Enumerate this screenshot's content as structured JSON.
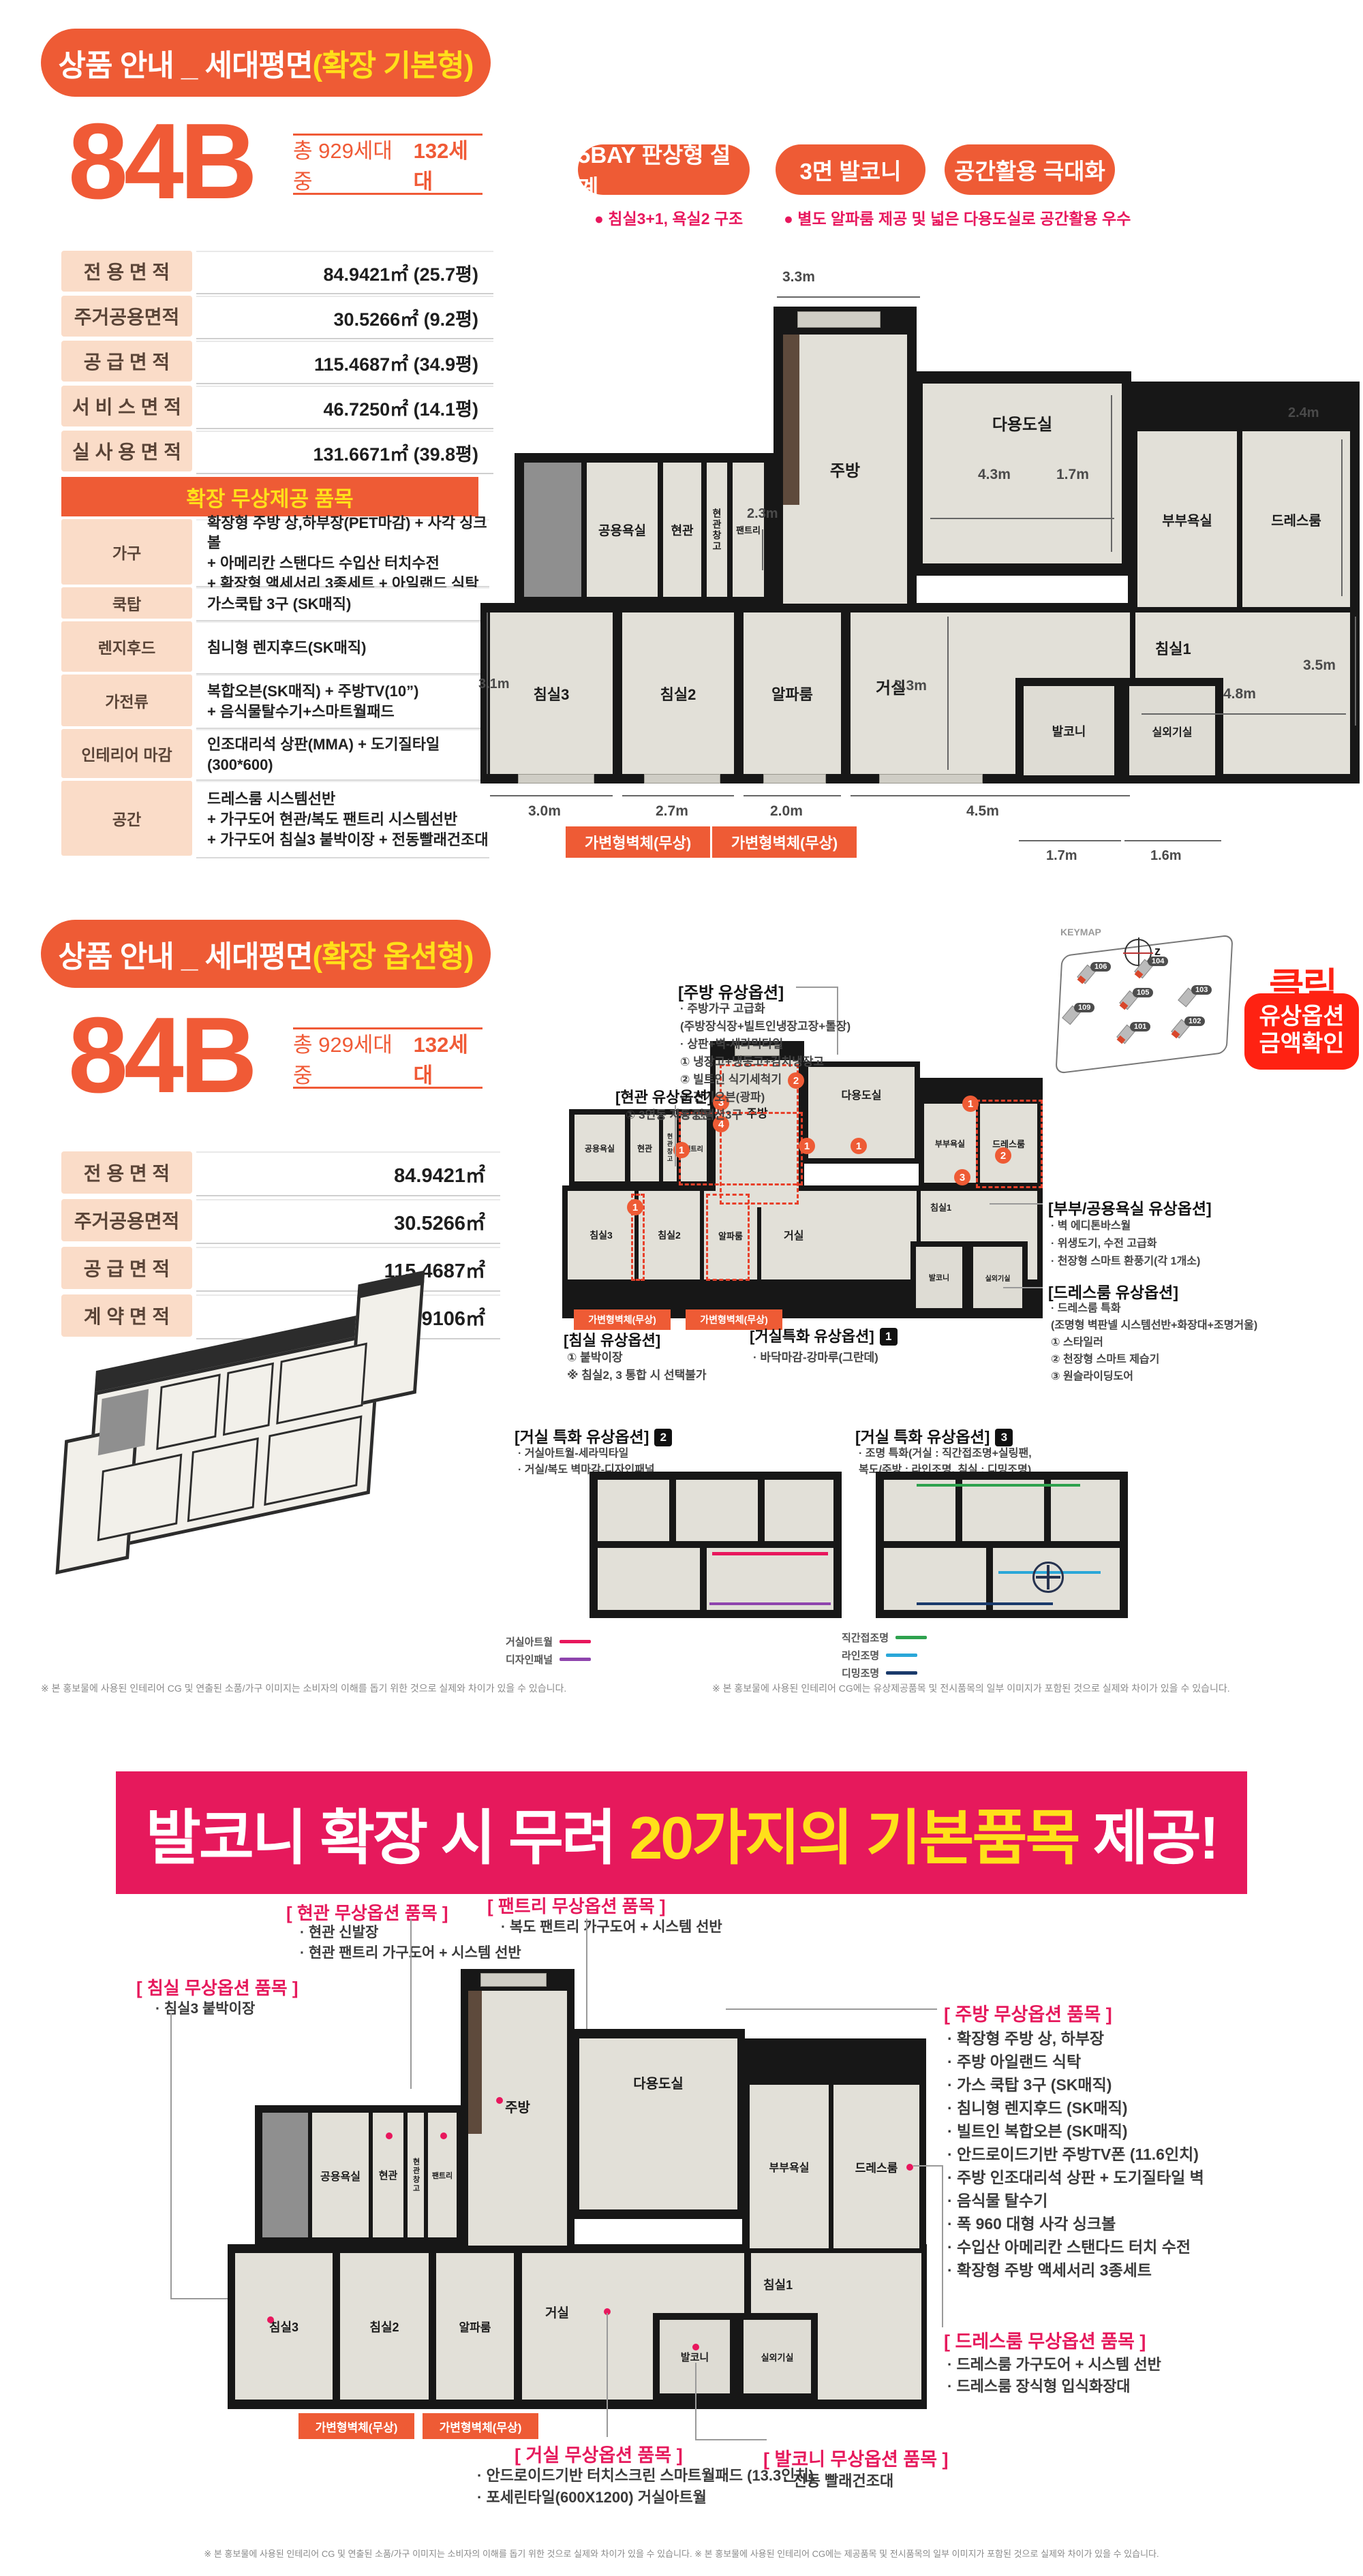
{
  "rooms": {
    "kitchen": "주방",
    "utility": "다용도실",
    "bath_common": "공용욕실",
    "entry": "현관",
    "entry_closet": "현관창고",
    "pantry": "팬트리",
    "bath_master": "부부욕실",
    "dress": "드레스룸",
    "bed3": "침실3",
    "bed2": "침실2",
    "alpha": "알파룸",
    "living": "거실",
    "bed1": "침실1",
    "balcony": "발코니",
    "ac_room": "실외기실"
  },
  "wall_tag": "가변형벽체(무상)",
  "section1": {
    "header_title": "상품 안내 _ 세대평면",
    "header_sub": "(확장 기본형)",
    "unit_code": "84B",
    "households_prefix": "총 929세대 중 ",
    "households_bold": "132세대",
    "badges": [
      "5BAY 판상형 설계",
      "3면 발코니",
      "공간활용 극대화"
    ],
    "badge_notes": [
      "● 침실3+1, 욕실2 구조",
      "● 별도 알파룸 제공 및 넓은 다용도실로 공간활용 우수"
    ],
    "area_rows": [
      [
        "전 용 면 적",
        "84.9421㎡ (25.7평)"
      ],
      [
        "주거공용면적",
        "30.5266㎡ (9.2평)"
      ],
      [
        "공 급 면 적",
        "115.4687㎡ (34.9평)"
      ],
      [
        "서 비 스 면 적",
        "46.7250㎡ (14.1평)"
      ],
      [
        "실 사 용 면 적",
        "131.6671㎡ (39.8평)"
      ]
    ],
    "free_table_title": "확장 무상제공 품목",
    "free_rows": [
      [
        "가구",
        "확장형 주방 상,하부장(PET마감) + 사각 싱크볼\n+ 아메리칸 스탠다드 수입산 터치수전\n+ 확장형 액세서리 3종세트 + 아일랜드 식탁"
      ],
      [
        "쿡탑",
        "가스쿡탑 3구 (SK매직)"
      ],
      [
        "렌지후드",
        "침니형 렌지후드(SK매직)"
      ],
      [
        "가전류",
        "복합오븐(SK매직) + 주방TV(10”)\n+ 음식물탈수기+스마트월패드"
      ],
      [
        "인테리어 마감",
        "인조대리석 상판(MMA) + 도기질타일(300*600)"
      ],
      [
        "공간",
        "드레스룸 시스템선반\n+ 가구도어 현관/복도 팬트리 시스템선반\n+ 가구도어 침실3 붙박이장 + 전동빨래건조대"
      ]
    ],
    "dims": {
      "top": "3.3m",
      "utility_w": "4.3m",
      "utility_d": "1.7m",
      "corridor": "2.3m",
      "dress_d": "2.4m",
      "bed3_h": "3.1m",
      "living_h": "3.3m",
      "bed1_h": "3.5m",
      "bed1_w": "4.8m",
      "bed3_w": "3.0m",
      "bed2_w": "2.7m",
      "alpha_w": "2.0m",
      "living_w": "4.5m",
      "balcony_w": "1.7m",
      "ac_w": "1.6m"
    }
  },
  "section2": {
    "header_title": "상품 안내 _ 세대평면",
    "header_sub": "(확장 옵션형)",
    "unit_code": "84B",
    "households_prefix": "총 929세대 중 ",
    "households_bold": "132세대",
    "area_rows": [
      [
        "전 용 면 적",
        "84.9421㎡"
      ],
      [
        "주거공용면적",
        "30.5266㎡"
      ],
      [
        "공 급 면 적",
        "115.4687㎡"
      ],
      [
        "계 약 면 적",
        "175.9106㎡"
      ]
    ],
    "keymap_label": "KEYMAP",
    "compass_letter": "z",
    "keymap_buildings": [
      "106",
      "104",
      "105",
      "103",
      "109",
      "101",
      "102"
    ],
    "click_badge": {
      "word": "클릭",
      "line1": "유상옵션",
      "line2": "금액확인"
    },
    "markers": {
      "n1": "1",
      "n2": "2",
      "n3": "3",
      "n4": "4"
    },
    "callouts": {
      "kitchen": {
        "title": "[주방 유상옵션]",
        "items": [
          "· 주방가구 고급화",
          "  (주방장식장+빌트인냉장고장+톨장)",
          "· 상판+벽-세라믹타일",
          "① 냉장고+냉동고+김치냉장고",
          "② 빌트인 식기세척기",
          "③ 전기오븐(광파)",
          "④ 인덕션3구"
        ]
      },
      "entry": {
        "title": "[현관 유상옵션]",
        "items": [
          "① 3연동 자동중문"
        ]
      },
      "bath": {
        "title": "[부부/공용욕실 유상옵션]",
        "items": [
          "· 벽 에디톤바스월",
          "· 위생도기, 수전 고급화",
          "· 천장형 스마트 환풍기(각 1개소)"
        ]
      },
      "dress": {
        "title": "[드레스룸 유상옵션]",
        "items": [
          "· 드레스룸 특화",
          "  (조명형 벽판넬 시스템선반+화장대+조명거울)",
          "① 스타일러",
          "② 천장형 스마트 제습기",
          "③ 원슬라이딩도어"
        ]
      },
      "bed": {
        "title": "[침실 유상옵션]",
        "items": [
          "① 붙박이장",
          "※ 침실2, 3 통합 시 선택불가"
        ]
      },
      "living1": {
        "title": "[거실특화 유상옵션]",
        "num": "1",
        "items": [
          "· 바닥마감-강마루(그란데)"
        ]
      },
      "living2": {
        "title": "[거실 특화 유상옵션]",
        "num": "2",
        "items": [
          "· 거실아트월-세라믹타일",
          "· 거실/복도 벽마감-디자인패널"
        ]
      },
      "living3": {
        "title": "[거실 특화 유상옵션]",
        "num": "3",
        "items": [
          "· 조명 특화(거실 : 직간접조명+실링팬,",
          "  복도/주방 : 라인조명, 침실 : 디밍조명)"
        ]
      }
    },
    "legend2": [
      {
        "label": "거실아트월",
        "color": "#e8175d"
      },
      {
        "label": "디자인패널",
        "color": "#8e44ad"
      }
    ],
    "legend3": [
      {
        "label": "직간접조명",
        "color": "#2ea24e"
      },
      {
        "label": "라인조명",
        "color": "#2aa7d8"
      },
      {
        "label": "디밍조명",
        "color": "#1a3a6b"
      }
    ],
    "disclaimer_left": "※ 본 홍보물에 사용된 인테리어 CG 및 연출된 소품/가구 이미지는 소비자의 이해를 돕기 위한 것으로 실제와 차이가 있을 수 있습니다.",
    "disclaimer_right": "※ 본 홍보물에 사용된 인테리어 CG에는 유상제공품목 및 전시품목의 일부 이미지가 포함된 것으로 실제와 차이가 있을 수 있습니다."
  },
  "banner": {
    "pre": "발코니 확장 시 무려 ",
    "highlight": "20가지의 기본품목",
    "post": " 제공!"
  },
  "section3": {
    "callouts": {
      "entry": {
        "title": "[ 현관 무상옵션 품목 ]",
        "items": [
          "· 현관 신발장",
          "· 현관 팬트리 가구도어 + 시스템 선반"
        ]
      },
      "pantry": {
        "title": "[ 팬트리 무상옵션 품목 ]",
        "items": [
          "· 복도 팬트리 가구도어 + 시스템 선반"
        ]
      },
      "bed": {
        "title": "[ 침실 무상옵션 품목 ]",
        "items": [
          "· 침실3 붙박이장"
        ]
      },
      "kitchen": {
        "title": "[ 주방 무상옵션 품목 ]",
        "items": [
          "· 확장형 주방 상, 하부장",
          "· 주방 아일랜드 식탁",
          "· 가스 쿡탑 3구 (SK매직)",
          "· 침니형 렌지후드 (SK매직)",
          "· 빌트인 복합오븐 (SK매직)",
          "· 안드로이드기반 주방TV폰 (11.6인치)",
          "· 주방 인조대리석 상판 + 도기질타일 벽",
          "· 음식물 탈수기",
          "· 폭 960 대형 사각 싱크볼",
          "· 수입산 아메리칸 스탠다드 터치 수전",
          "· 확장형 주방 액세서리 3종세트"
        ]
      },
      "dress": {
        "title": "[ 드레스룸 무상옵션 품목 ]",
        "items": [
          "· 드레스룸 가구도어 + 시스템 선반",
          "· 드레스룸 장식형 입식화장대"
        ]
      },
      "living": {
        "title": "[ 거실 무상옵션 품목 ]",
        "items": [
          "· 안드로이드기반 터치스크린 스마트월패드 (13.3인치)",
          "· 포세린타일(600X1200) 거실아트월"
        ]
      },
      "balcony": {
        "title": "[ 발코니 무상옵션 품목 ]",
        "items": [
          "· 전동 빨래건조대"
        ]
      }
    },
    "disclaimer": "※ 본 홍보물에 사용된 인테리어 CG 및 연출된 소품/가구 이미지는 소비자의 이해를 돕기 위한 것으로 실제와 차이가 있을 수 있습니다.   ※ 본 홍보물에 사용된 인테리어 CG에는 제공품목 및 전시품목의 일부 이미지가 포함된 것으로 실제와 차이가 있을 수 있습니다."
  }
}
